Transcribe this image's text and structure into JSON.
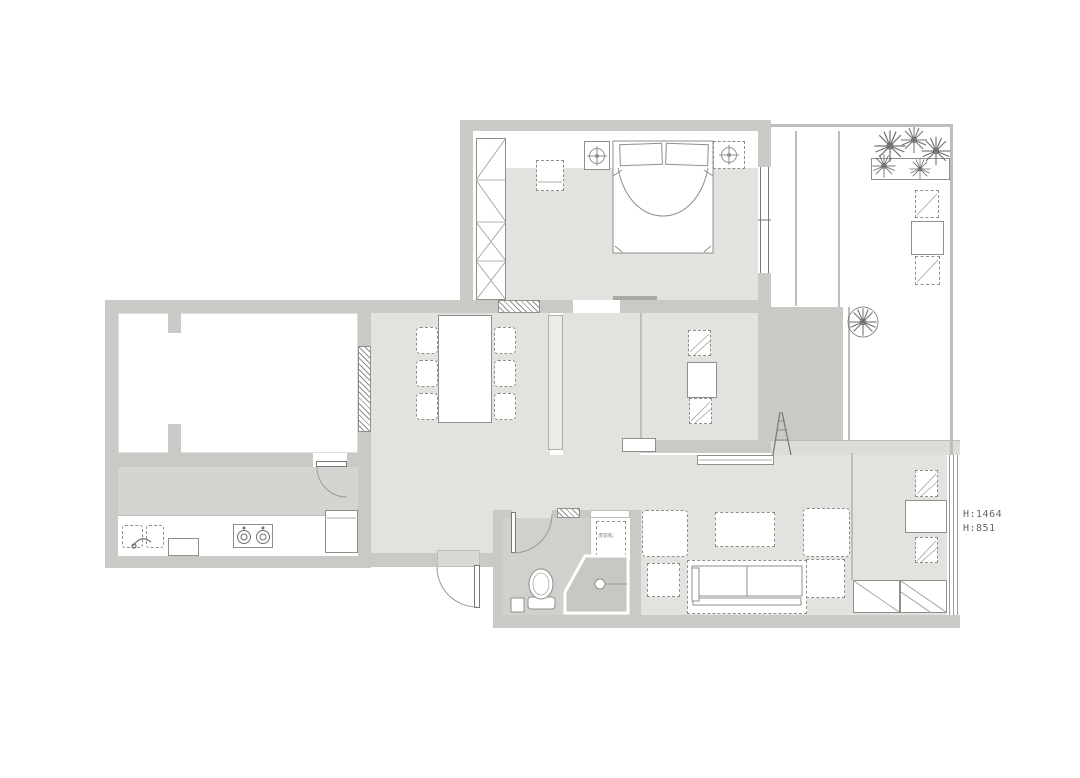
{
  "title": "apartment-floor-plan",
  "colors": {
    "bg": "#ffffff",
    "wall": "#c9c9c6",
    "wall-line": "#bdbdba",
    "floor": "#e3e2de",
    "kitchen-floor": "#d4d4d0",
    "bath-floor": "#d0d0cc",
    "shower-floor": "#c7c7c3",
    "deck": "#c9c9c5",
    "strip": "#dcdcd9",
    "threshold": "#d8d8d4",
    "stub": "#ebebe8",
    "ink": "#8f8f8b",
    "ink-dark": "#77777a",
    "text": "#68686a"
  },
  "labels": {
    "height_1": "H:1464",
    "height_2": "H:851",
    "washer": "洗衣机"
  },
  "icons": {
    "flower": "flower-icon",
    "tree": "tree-icon",
    "lamp": "ceiling-lamp-icon",
    "burner": "stove-burner-icon",
    "drain": "floor-drain-icon"
  }
}
